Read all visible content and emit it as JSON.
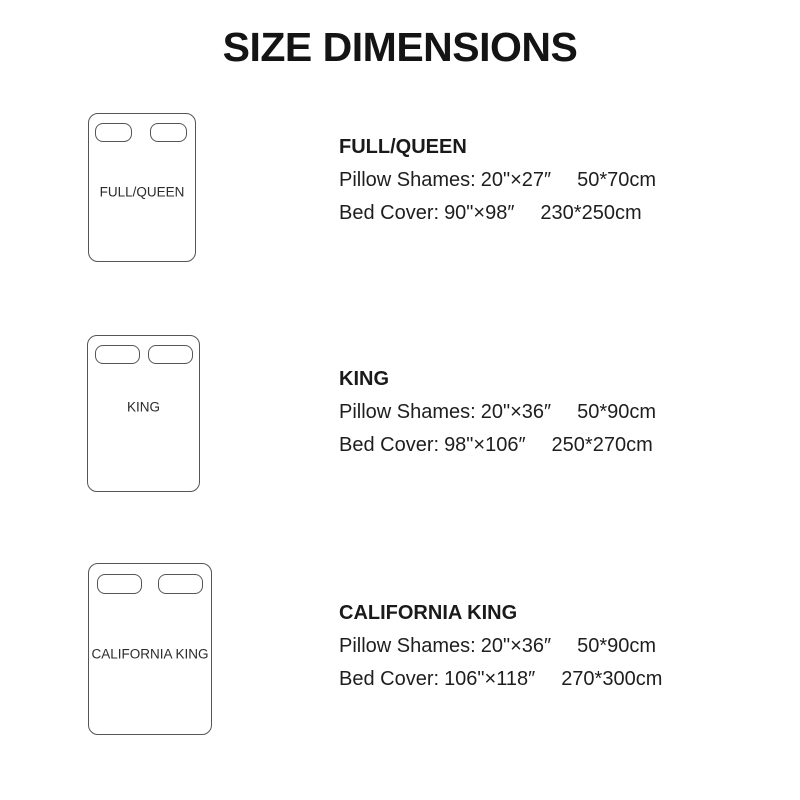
{
  "title": "SIZE DIMENSIONS",
  "colors": {
    "background": "#ffffff",
    "text": "#1e1e1e",
    "outline": "#555555"
  },
  "sizes": [
    {
      "name": "FULL/QUEEN",
      "diagram_label": "FULL/QUEEN",
      "pillow": {
        "label": "Pillow Shames:",
        "inches": "20\"×27″",
        "cm": "50*70cm"
      },
      "cover": {
        "label": "Bed Cover:",
        "inches": "90\"×98″",
        "cm": "230*250cm"
      }
    },
    {
      "name": "KING",
      "diagram_label": "KING",
      "pillow": {
        "label": "Pillow Shames:",
        "inches": "20\"×36″",
        "cm": "50*90cm"
      },
      "cover": {
        "label": "Bed Cover:",
        "inches": "98\"×106″",
        "cm": "250*270cm"
      }
    },
    {
      "name": "CALIFORNIA KING",
      "diagram_label": "CALIFORNIA KING",
      "pillow": {
        "label": "Pillow Shames:",
        "inches": "20\"×36″",
        "cm": "50*90cm"
      },
      "cover": {
        "label": "Bed Cover:",
        "inches": "106\"×118″",
        "cm": "270*300cm"
      }
    }
  ]
}
